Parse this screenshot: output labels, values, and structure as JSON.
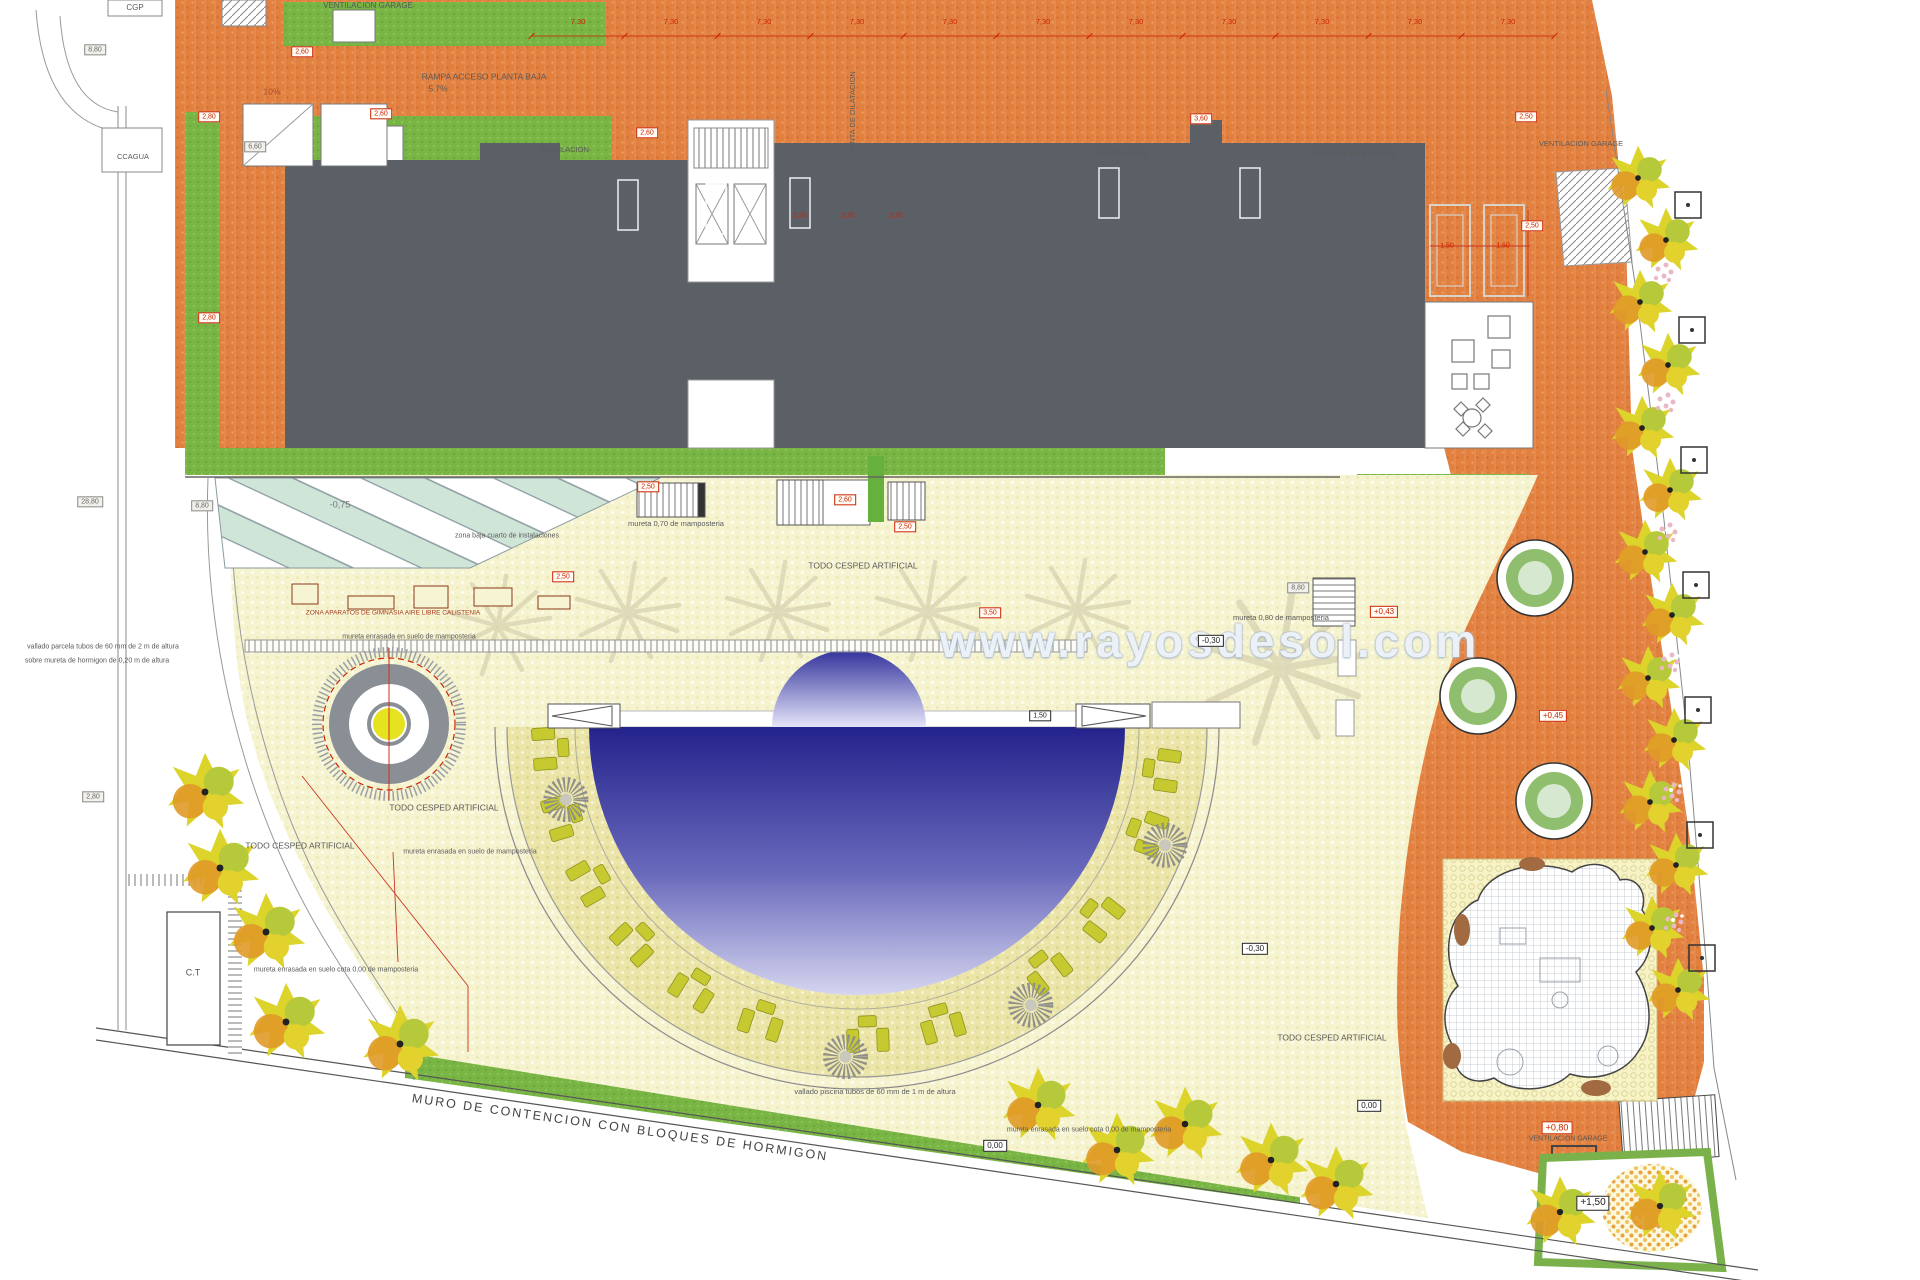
{
  "watermark": {
    "text": "www.rayosdesol.com",
    "x": 1210,
    "y": 641
  },
  "colors": {
    "orange": "#e2803f",
    "building": "#5b6067",
    "green": "#79b544",
    "cream": "#f5f3d0",
    "ring": "#ebe6ad",
    "pool_dark": "#23238c",
    "pool_light": "#d9d9f2",
    "red": "#cc2200"
  },
  "labels": [
    {
      "t": "VENTILACION GARAGE",
      "x": 368,
      "y": 6,
      "s": 8
    },
    {
      "t": "CGP",
      "x": 135,
      "y": 8,
      "s": 8
    },
    {
      "t": "RAMPA ACCESO PLANTA BAJA",
      "x": 484,
      "y": 77,
      "s": 8.5
    },
    {
      "t": "5.7%",
      "x": 438,
      "y": 89,
      "s": 8.5
    },
    {
      "t": "10%",
      "x": 272,
      "y": 92,
      "s": 8.5,
      "c": "#a34a2a"
    },
    {
      "t": "CCAGUA",
      "x": 133,
      "y": 157,
      "s": 7.5
    },
    {
      "t": "VENTILACION",
      "x": 564,
      "y": 150,
      "s": 7.5
    },
    {
      "t": "VENTILACION",
      "x": 1122,
      "y": 154,
      "s": 7.5
    },
    {
      "t": "JUNTA DE DILATACION",
      "x": 1353,
      "y": 154,
      "s": 7.5
    },
    {
      "t": "JUNTA DE DILATACION",
      "x": 853,
      "y": 112,
      "s": 7.5,
      "r": -90
    },
    {
      "t": "VENTILACION GARAGE",
      "x": 1581,
      "y": 144,
      "s": 7.5
    },
    {
      "t": "zona baja cuarto de instalaciones",
      "x": 507,
      "y": 536,
      "s": 7
    },
    {
      "t": "-0,75",
      "x": 340,
      "y": 505,
      "s": 9,
      "c": "#777777"
    },
    {
      "t": "mureta 0,70 de mamposteria",
      "x": 676,
      "y": 524,
      "s": 7.5
    },
    {
      "t": "TODO CESPED ARTIFICIAL",
      "x": 863,
      "y": 566,
      "s": 8.5
    },
    {
      "t": "ZONA APARATOS DE GIMNASIA AIRE LIBRE CALISTENIA",
      "x": 393,
      "y": 614,
      "s": 6.5,
      "c": "#a33a1a"
    },
    {
      "t": "mureta enrasada en suelo de mamposteria",
      "x": 409,
      "y": 637,
      "s": 7
    },
    {
      "t": "mureta 0,80 de mamposteria",
      "x": 1281,
      "y": 618,
      "s": 7.5
    },
    {
      "t": "TODO CESPED ARTIFICIAL",
      "x": 444,
      "y": 808,
      "s": 8.5
    },
    {
      "t": "TODO CESPED ARTIFICIAL",
      "x": 300,
      "y": 846,
      "s": 8.5
    },
    {
      "t": "TODO CESPED ARTIFICIAL",
      "x": 1332,
      "y": 1038,
      "s": 8.5
    },
    {
      "t": "mureta enrasada en suelo de mamposteria",
      "x": 470,
      "y": 852,
      "s": 7
    },
    {
      "t": "mureta enrasada en suelo cota 0,00 de mamposteria",
      "x": 336,
      "y": 970,
      "s": 7
    },
    {
      "t": "mureta enrasada en suelo cota 0,00 de mamposteria",
      "x": 1089,
      "y": 1130,
      "s": 7
    },
    {
      "t": "vallado piscina tubos de 60 mm de 1 m de altura",
      "x": 875,
      "y": 1092,
      "s": 7.5
    },
    {
      "t": "vallado parcela tubos de 60 mm de 2 m de altura",
      "x": 103,
      "y": 647,
      "s": 7
    },
    {
      "t": "sobre mureta de hormigon de 0,20 m de altura",
      "x": 97,
      "y": 661,
      "s": 7
    },
    {
      "t": "MURO DE CONTENCION  CON BLOQUES DE HORMIGON",
      "x": 620,
      "y": 1128,
      "s": 12.5,
      "r": 8,
      "c": "#444444",
      "ls": 2
    },
    {
      "t": "C.T",
      "x": 193,
      "y": 973,
      "s": 9,
      "c": "#555555"
    },
    {
      "t": "VENTILACION GARAGE",
      "x": 1568,
      "y": 1139,
      "s": 7
    },
    {
      "t": "2,50",
      "x": 800,
      "y": 216,
      "s": 7,
      "c": "#cc2200"
    },
    {
      "t": "2,30",
      "x": 848,
      "y": 216,
      "s": 7,
      "c": "#cc2200"
    },
    {
      "t": "2,30",
      "x": 896,
      "y": 216,
      "s": 7,
      "c": "#cc2200"
    },
    {
      "t": "1,50",
      "x": 1447,
      "y": 246,
      "s": 7,
      "c": "#cc2200"
    },
    {
      "t": "1,50",
      "x": 1503,
      "y": 246,
      "s": 7,
      "c": "#cc2200"
    },
    {
      "t": "2,60",
      "x": 302,
      "y": 52,
      "s": 7,
      "b": "red"
    },
    {
      "t": "2,60",
      "x": 381,
      "y": 114,
      "s": 7,
      "b": "red"
    },
    {
      "t": "2,80",
      "x": 209,
      "y": 117,
      "s": 7,
      "b": "red"
    },
    {
      "t": "2,80",
      "x": 209,
      "y": 318,
      "s": 7,
      "b": "red"
    },
    {
      "t": "2,60",
      "x": 647,
      "y": 133,
      "s": 7,
      "b": "red"
    },
    {
      "t": "3,60",
      "x": 1201,
      "y": 119,
      "s": 7,
      "b": "red"
    },
    {
      "t": "2,50",
      "x": 1526,
      "y": 117,
      "s": 7,
      "b": "red"
    },
    {
      "t": "2,50",
      "x": 1532,
      "y": 226,
      "s": 7,
      "b": "red"
    },
    {
      "t": "2,50",
      "x": 648,
      "y": 487,
      "s": 7,
      "b": "red"
    },
    {
      "t": "2,60",
      "x": 845,
      "y": 500,
      "s": 7,
      "b": "red"
    },
    {
      "t": "2,50",
      "x": 905,
      "y": 527,
      "s": 7,
      "b": "red"
    },
    {
      "t": "2,50",
      "x": 563,
      "y": 577,
      "s": 7,
      "b": "red"
    },
    {
      "t": "3,50",
      "x": 990,
      "y": 613,
      "s": 7,
      "b": "red"
    },
    {
      "t": "+0,43",
      "x": 1384,
      "y": 612,
      "s": 8,
      "b": "red"
    },
    {
      "t": "+0,45",
      "x": 1553,
      "y": 716,
      "s": 8,
      "b": "red"
    },
    {
      "t": "+0,80",
      "x": 1557,
      "y": 1128,
      "s": 9,
      "b": "red"
    },
    {
      "t": "-0,30",
      "x": 1211,
      "y": 641,
      "s": 8,
      "b": "black"
    },
    {
      "t": "-0,30",
      "x": 1255,
      "y": 949,
      "s": 8,
      "b": "black"
    },
    {
      "t": "0,00",
      "x": 995,
      "y": 1146,
      "s": 8,
      "b": "black"
    },
    {
      "t": "0,00",
      "x": 1369,
      "y": 1106,
      "s": 8,
      "b": "black"
    },
    {
      "t": "+1,50",
      "x": 1593,
      "y": 1203,
      "s": 10,
      "b": "black"
    },
    {
      "t": "1,50",
      "x": 1040,
      "y": 716,
      "s": 7,
      "b": "black"
    },
    {
      "t": "8,80",
      "x": 95,
      "y": 50,
      "s": 7,
      "b": "gray"
    },
    {
      "t": "6,60",
      "x": 255,
      "y": 147,
      "s": 7,
      "b": "gray"
    },
    {
      "t": "28,80",
      "x": 90,
      "y": 502,
      "s": 7,
      "b": "gray"
    },
    {
      "t": "8,80",
      "x": 202,
      "y": 506,
      "s": 7,
      "b": "gray"
    },
    {
      "t": "2,80",
      "x": 93,
      "y": 797,
      "s": 7,
      "b": "gray"
    },
    {
      "t": "8,80",
      "x": 1298,
      "y": 588,
      "s": 7,
      "b": "gray"
    }
  ],
  "top_dims": {
    "text": "7,30",
    "y": 22,
    "x_start": 578,
    "step": 93,
    "count": 11,
    "line_y": 36
  },
  "pool": {
    "cx": 857,
    "chord_y": 727,
    "r": 268,
    "dome_cx": 849,
    "dome_r": 77,
    "ring_r1": 282,
    "ring_r2": 350,
    "fence_r": 362,
    "bench_angles": [
      176,
      163,
      150,
      136,
      122,
      108,
      88,
      74,
      52,
      38,
      20,
      8
    ],
    "bench_radius": 308,
    "suns": [
      [
        166,
        300
      ],
      [
        92,
        330
      ],
      [
        58,
        328
      ],
      [
        21,
        330
      ]
    ]
  },
  "palms": [
    [
      498,
      626,
      1
    ],
    [
      627,
      613,
      1
    ],
    [
      777,
      612,
      1
    ],
    [
      927,
      612,
      1
    ],
    [
      1077,
      610,
      1
    ],
    [
      1280,
      668,
      1.55
    ]
  ],
  "planters": [
    [
      1535,
      578
    ],
    [
      1478,
      696
    ],
    [
      1554,
      801
    ]
  ],
  "trees": {
    "groups": [
      {
        "s": 0.95,
        "pts": [
          [
            1638,
            178
          ],
          [
            1666,
            240
          ],
          [
            1640,
            302
          ],
          [
            1668,
            365
          ],
          [
            1642,
            428
          ],
          [
            1670,
            490
          ],
          [
            1645,
            552
          ],
          [
            1672,
            615
          ],
          [
            1648,
            678
          ],
          [
            1674,
            740
          ],
          [
            1650,
            802
          ],
          [
            1676,
            865
          ],
          [
            1652,
            928
          ],
          [
            1678,
            990
          ]
        ]
      },
      {
        "s": 1.15,
        "pts": [
          [
            205,
            792
          ],
          [
            220,
            868
          ],
          [
            266,
            932
          ],
          [
            286,
            1022
          ],
          [
            400,
            1044
          ]
        ]
      },
      {
        "s": 1.1,
        "pts": [
          [
            1038,
            1105
          ],
          [
            1117,
            1150
          ],
          [
            1185,
            1124
          ],
          [
            1271,
            1160
          ],
          [
            1336,
            1184
          ]
        ]
      },
      {
        "s": 1.05,
        "pts": [
          [
            1560,
            1212
          ],
          [
            1660,
            1206
          ]
        ]
      }
    ],
    "pits": [
      [
        1688,
        205
      ],
      [
        1692,
        330
      ],
      [
        1694,
        460
      ],
      [
        1696,
        585
      ],
      [
        1698,
        710
      ],
      [
        1700,
        835
      ],
      [
        1702,
        958
      ]
    ],
    "pinks": [
      [
        1664,
        272
      ],
      [
        1666,
        402
      ],
      [
        1668,
        532
      ],
      [
        1670,
        662
      ],
      [
        1672,
        792
      ],
      [
        1674,
        922
      ]
    ]
  },
  "gym_boxes": [
    [
      292,
      584,
      26,
      20
    ],
    [
      348,
      596,
      46,
      13
    ],
    [
      414,
      586,
      34,
      22
    ],
    [
      474,
      588,
      38,
      18
    ],
    [
      538,
      596,
      32,
      13
    ]
  ],
  "white_slots": [
    [
      618,
      180
    ],
    [
      706,
      184
    ],
    [
      790,
      178
    ],
    [
      1099,
      168
    ],
    [
      1240,
      168
    ]
  ],
  "double_slots": [
    [
      1430,
      205
    ],
    [
      1484,
      205
    ]
  ],
  "red_lines": [
    [
      389,
      652,
      389,
      800
    ],
    [
      302,
      776,
      468,
      986
    ],
    [
      468,
      986,
      468,
      1052
    ],
    [
      393,
      852,
      398,
      962
    ],
    [
      1430,
      246,
      1530,
      246
    ],
    [
      1528,
      210,
      1528,
      296
    ]
  ]
}
